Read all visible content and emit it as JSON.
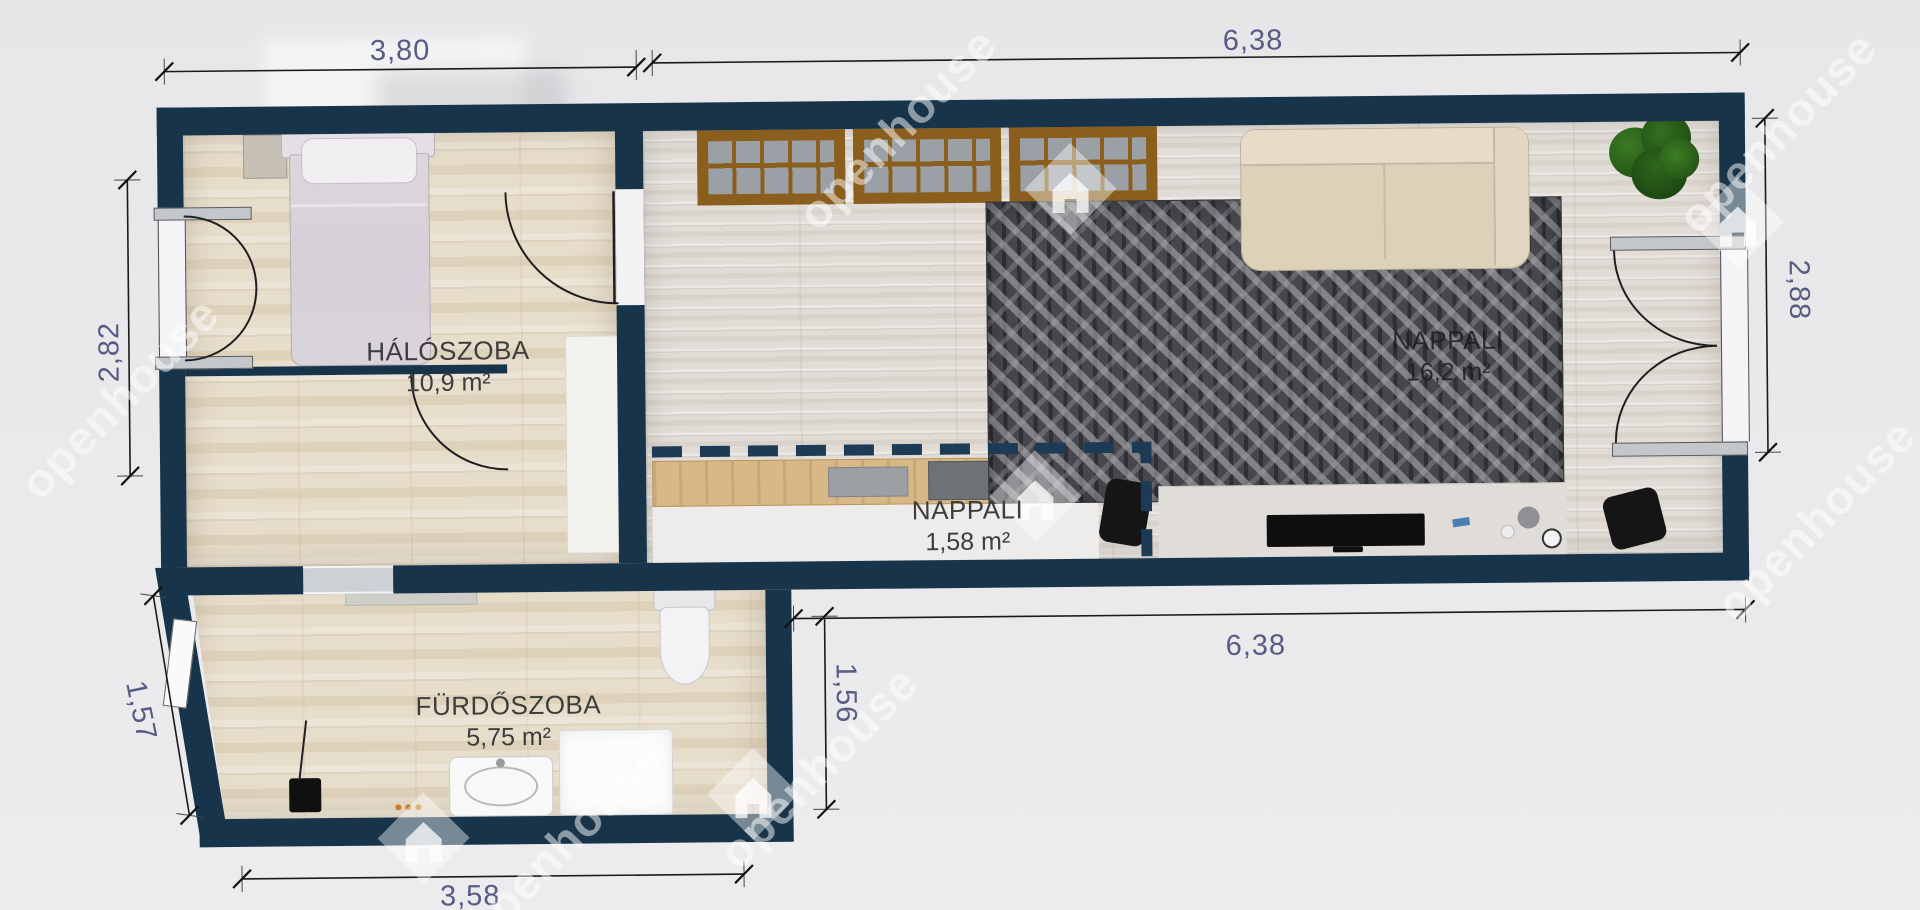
{
  "watermark": {
    "text": "openhouse"
  },
  "rooms": {
    "bedroom": {
      "name": "HÁLÓSZOBA",
      "area": "10,9 m²"
    },
    "living_small": {
      "name": "NAPPALI",
      "area": "1,58 m²"
    },
    "living_main": {
      "name": "NAPPALI",
      "area": "16,2 m²"
    },
    "bathroom": {
      "name": "FÜRDŐSZOBA",
      "area": "5,75 m²"
    }
  },
  "dimensions": {
    "top_bedroom": "3,80",
    "top_living": "6,38",
    "left_bedroom": "2,82",
    "right_living": "2,88",
    "left_bathroom": "1,57",
    "middle_bathroom": "1,56",
    "bottom_living": "6,38",
    "bottom_bathroom": "3,58"
  },
  "colors": {
    "wall": "#17344b",
    "dimension_text": "#575c84",
    "label_text": "#3d3d3d",
    "background": "#e9e9ec",
    "rug": "#46484d",
    "sofa": "#ddd1ba",
    "shelf_wood": "#8a5f1d"
  }
}
